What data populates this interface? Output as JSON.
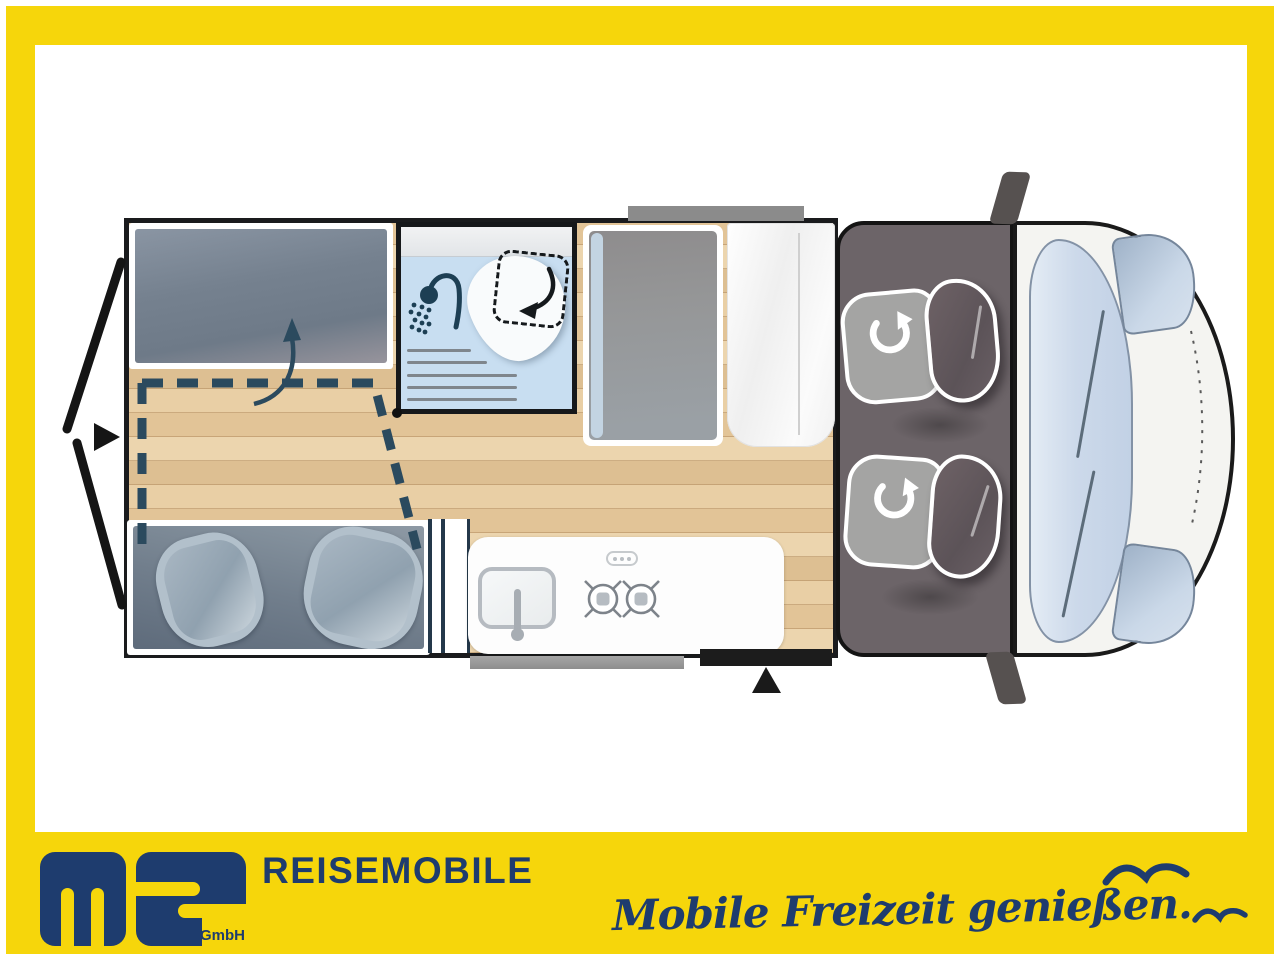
{
  "branding": {
    "logo_letters": "ms",
    "logo_suffix": "GmbH",
    "brand_name": "REISEMOBILE",
    "tagline": "Mobile Freizeit genießen."
  },
  "colors": {
    "frame_yellow": "#F6D60B",
    "brand_navy": "#1E3C6E",
    "plan_dashed_accent": "#2B4A5E",
    "cab_gray": "#6C6468",
    "shower_blue": "#C8DEF1",
    "wood_tan": "#E6C89E",
    "mattress_gray": "#76828F"
  },
  "floorplan_icons": [
    {
      "name": "rear-door-arrow-icon",
      "meaning": "rear doors open direction"
    },
    {
      "name": "fold-up-arrow-icon",
      "meaning": "bed folds up"
    },
    {
      "name": "shower-icon",
      "meaning": "shower"
    },
    {
      "name": "swivel-toilet-arrow-icon",
      "meaning": "swivelling toilet"
    },
    {
      "name": "rotate-seat-icon",
      "meaning": "swivelling cab seat"
    },
    {
      "name": "entrance-arrow-icon",
      "meaning": "sliding door entrance"
    },
    {
      "name": "sink-icon",
      "meaning": "kitchen sink"
    },
    {
      "name": "two-burner-hob-icon",
      "meaning": "two burner gas hob"
    },
    {
      "name": "seagull-icon",
      "meaning": "brand seagull"
    }
  ]
}
